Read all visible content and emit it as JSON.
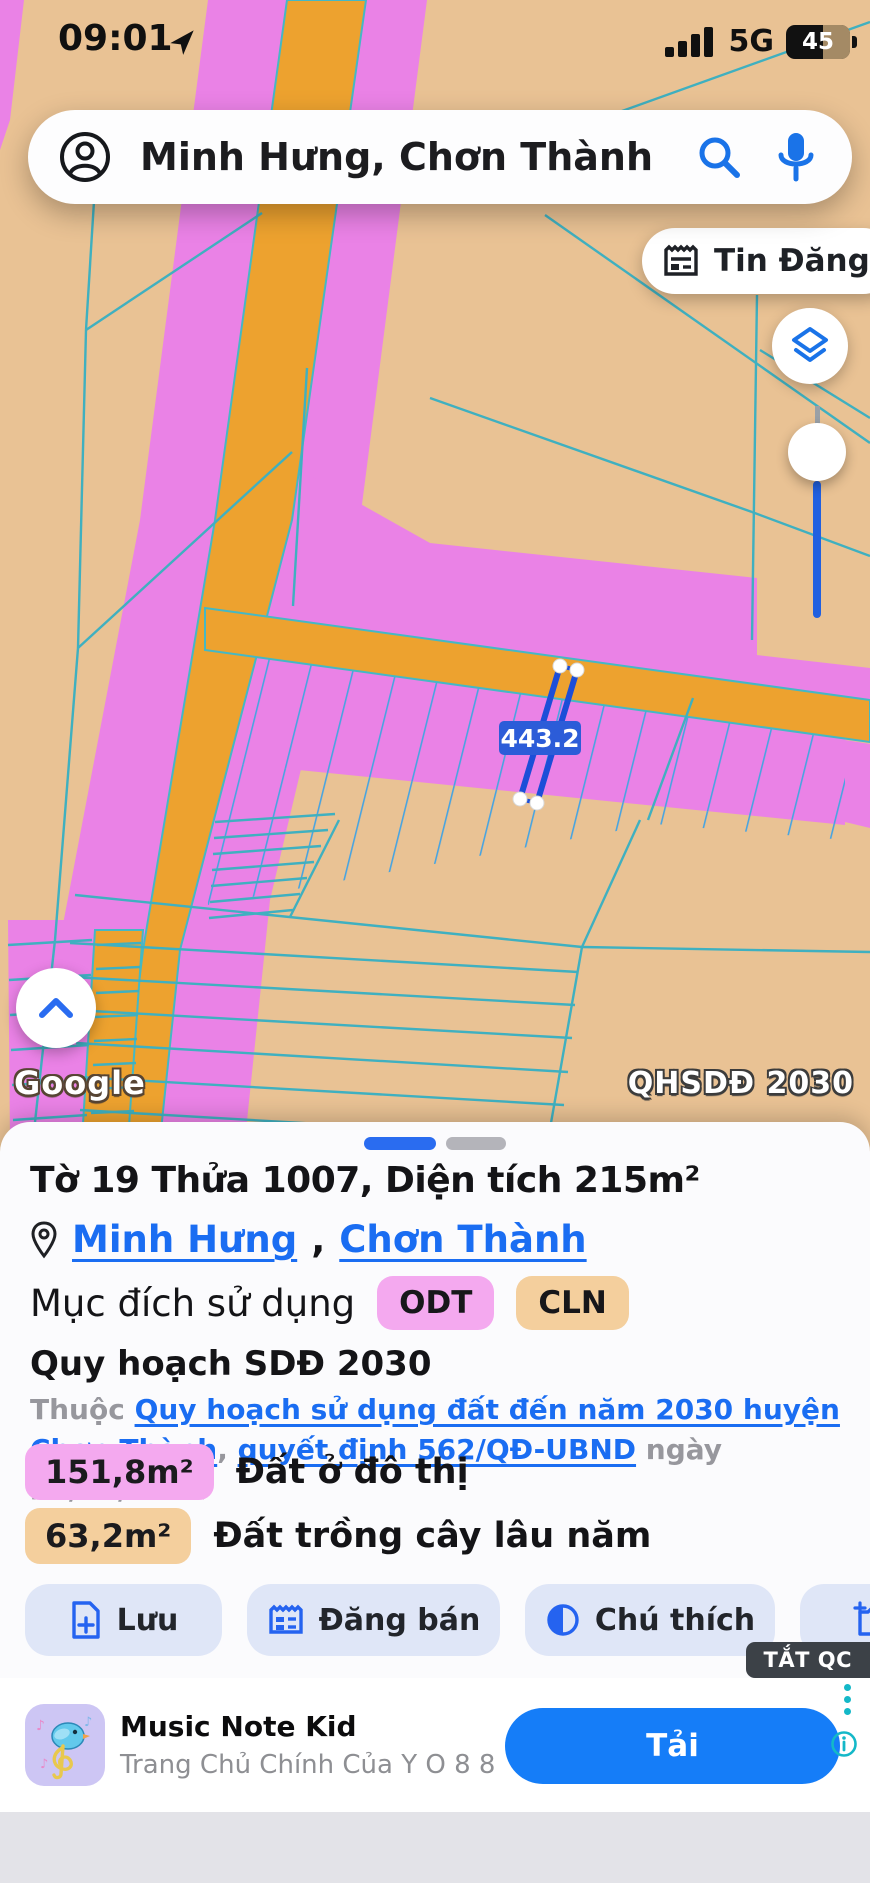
{
  "status": {
    "time": "09:01",
    "network": "5G",
    "battery": "45"
  },
  "search": {
    "query": "Minh Hưng, Chơn Thành"
  },
  "map": {
    "tin_dang": "Tin Đăng",
    "parcel_area_label": "443.2",
    "google": "Google",
    "overlay_badge": "QHSDĐ 2030",
    "colors": {
      "zone_pink": "#ea82e6",
      "zone_tan": "#e9c294",
      "road_orange": "#eda22f",
      "boundary_cyan": "#3fb0c0",
      "selection_blue": "#1c4ed8"
    }
  },
  "sheet": {
    "title": "Tờ 19 Thửa 1007, Diện tích 215m²",
    "location": {
      "ward": "Minh Hưng",
      "comma": ",",
      "district": "Chơn Thành"
    },
    "land_use": {
      "label": "Mục đích sử dụng",
      "badges": [
        {
          "code": "ODT"
        },
        {
          "code": "CLN"
        }
      ]
    },
    "planning": {
      "heading": "Quy hoạch SDĐ 2030",
      "prefix": "Thuộc ",
      "link1": "Quy hoạch sử dụng đất đến năm 2030 huyện Chơn Thành",
      "sep": ", ",
      "link2": "quyết định 562/QĐ-UBND",
      "suffix": " ngày 25/03/2022"
    },
    "zones": [
      {
        "area": "151,8m²",
        "name": "Đất ở đô thị"
      },
      {
        "area": "63,2m²",
        "name": "Đất trồng cây lâu năm"
      }
    ],
    "actions": [
      {
        "label": "Lưu"
      },
      {
        "label": "Đăng bán"
      },
      {
        "label": "Chú thích"
      }
    ]
  },
  "ad": {
    "dismiss": "TẮT QC",
    "title": "Music Note Kid",
    "subtitle": "Trang Chủ Chính Của Y O 8 8",
    "cta": "Tải"
  }
}
